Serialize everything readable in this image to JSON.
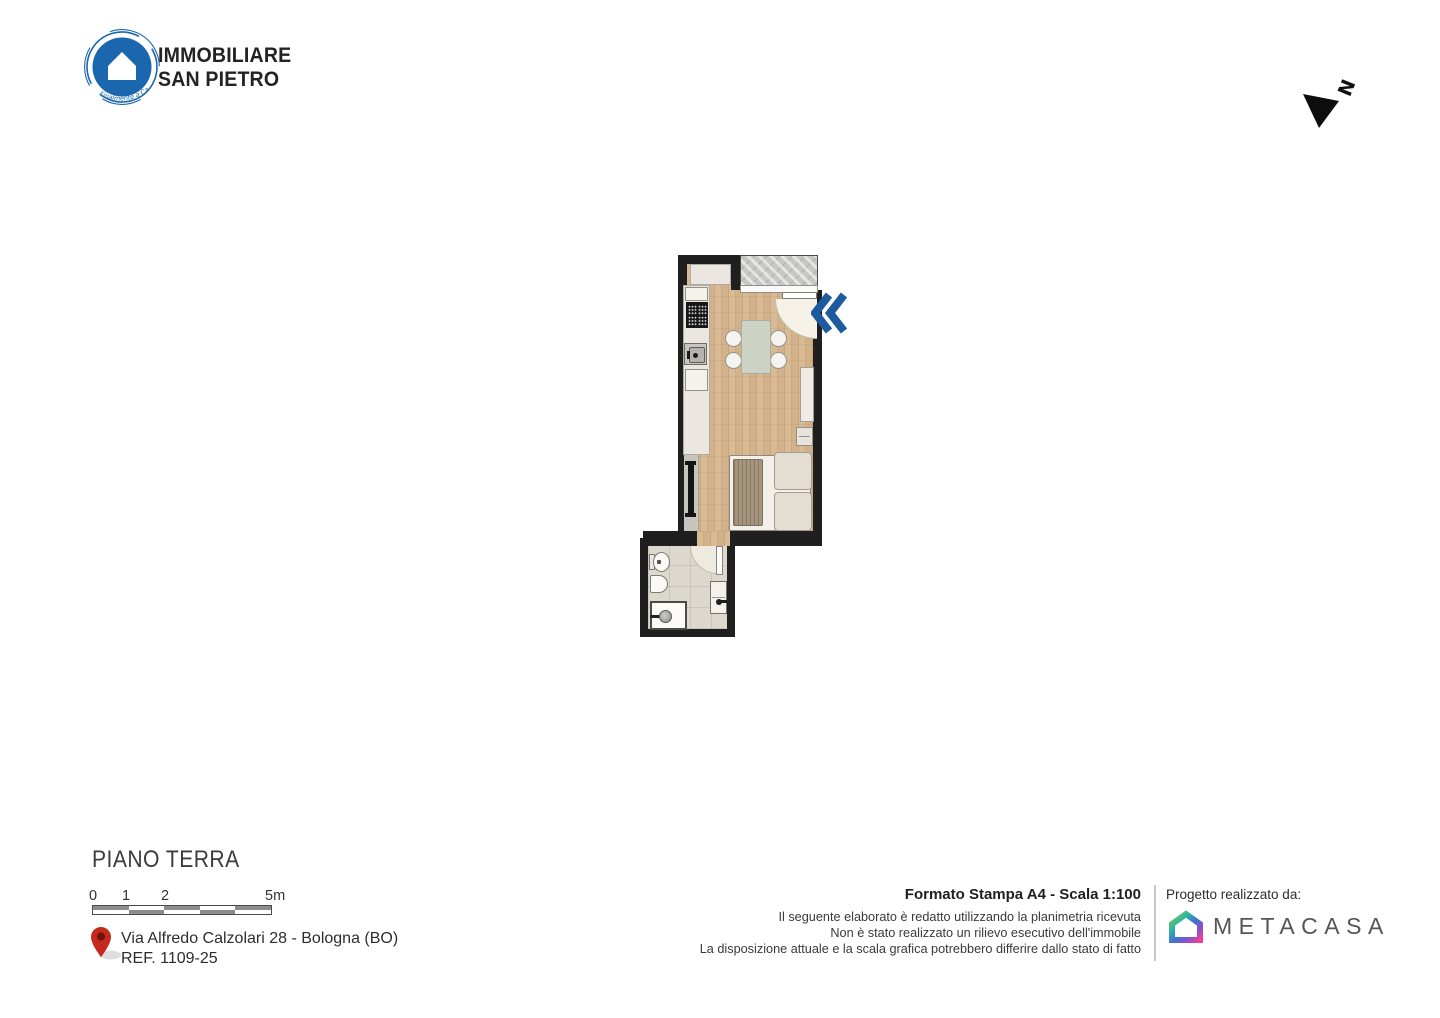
{
  "header": {
    "logo": {
      "line1": "IMMOBILIARE",
      "line2": "SAN PIETRO",
      "tagline": "Finalmente a Casa"
    },
    "compass_letter": "N"
  },
  "plan": {
    "entrance_indicator": "double-chevron-left",
    "colors": {
      "wall": "#1f1f1f",
      "wood_floor": "#d3b28b",
      "entrance_blue": "#1e5b9e",
      "table_sage": "#ccd2c4",
      "bathroom_tile": "#ddd8cd"
    }
  },
  "footer": {
    "floor_label": "PIANO TERRA",
    "scale_labels": [
      "0",
      "1",
      "2",
      "5m"
    ],
    "address_line1": "Via Alfredo Calzolari 28 - Bologna (BO)",
    "address_line2": "REF. 1109-25",
    "print_format": "Formato Stampa A4 - Scala 1:100",
    "disclaimer": [
      "Il seguente elaborato è redatto utilizzando la planimetria ricevuta",
      "Non è stato realizzato un rilievo esecutivo dell'immobile",
      "La disposizione attuale e la scala grafica potrebbero differire dallo stato di fatto"
    ],
    "credit_label": "Progetto realizzato da:",
    "credit_brand": "METACASA"
  },
  "colors": {
    "accent_blue": "#1b67ae",
    "pin_red": "#c5281c",
    "metacasa_gradient": [
      "#8dc63f",
      "#2bb5a8",
      "#3f72cf",
      "#8a4fd0",
      "#ef3f97"
    ]
  }
}
